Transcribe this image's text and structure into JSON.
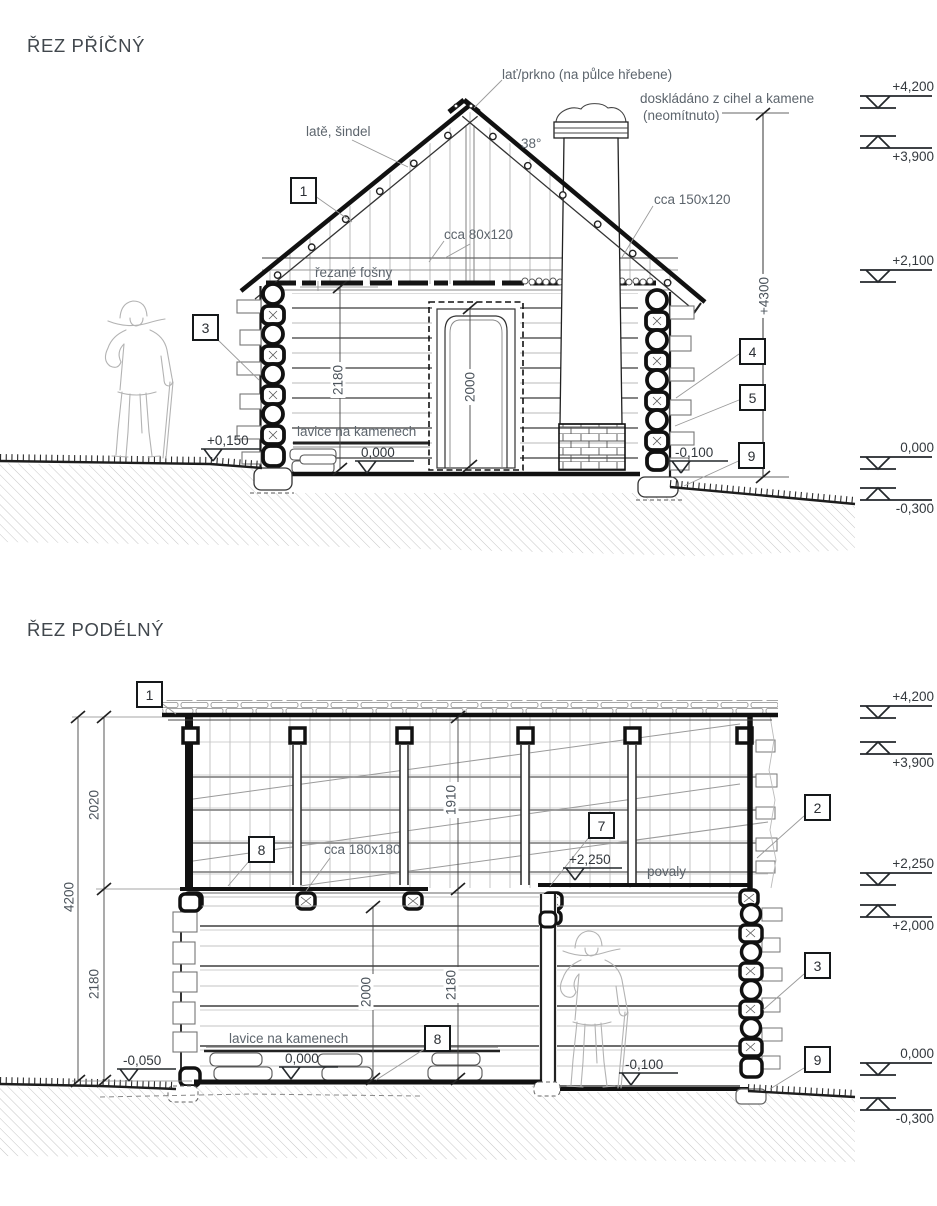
{
  "section1": {
    "title": "ŘEZ PŘÍČNÝ",
    "labels": {
      "ridge": "lať/prkno (na půlce hřebene)",
      "battens": "latě, šindel",
      "roof_angle": "38°",
      "chimney_note1": "doskládáno z cihel a kamene",
      "chimney_note2": "(neomítnuto)",
      "rafter_size": "cca 150x120",
      "tie_beam_size": "cca 80x120",
      "planks": "řezané fošny",
      "bench": "lavice na kamenech"
    },
    "dimensions": {
      "room_height": "2180",
      "door_height": "2000",
      "total_height": "+4300"
    },
    "spot_levels": {
      "terrain_left": "+0,150",
      "floor": "0,000",
      "terrain_right": "-0,100"
    },
    "callouts": {
      "c1": "1",
      "c3": "3",
      "c4": "4",
      "c5": "5",
      "c9": "9"
    },
    "level_marks": [
      {
        "label": "+4,200",
        "dir": "down"
      },
      {
        "label": "+3,900",
        "dir": "up"
      },
      {
        "label": "+2,100",
        "dir": "down"
      },
      {
        "label": "0,000",
        "dir": "down"
      },
      {
        "label": "-0,300",
        "dir": "up"
      }
    ]
  },
  "section2": {
    "title": "ŘEZ PODÉLNÝ",
    "labels": {
      "beam_size": "cca 180x180",
      "ceiling": "povaly",
      "bench": "lavice na kamenech"
    },
    "dimensions": {
      "total_height": "4200",
      "attic_height": "2020",
      "room_height": "2180",
      "attic_clear": "1910",
      "door_height": "2000",
      "room_clear": "2180"
    },
    "spot_levels": {
      "terrain_left": "-0,050",
      "ceiling_right": "+2,250",
      "floor": "0,000",
      "floor_right": "-0,100"
    },
    "callouts": {
      "c1": "1",
      "c2": "2",
      "c3": "3",
      "c7": "7",
      "c8a": "8",
      "c8b": "8",
      "c9": "9"
    },
    "level_marks": [
      {
        "label": "+4,200",
        "dir": "down"
      },
      {
        "label": "+3,900",
        "dir": "up"
      },
      {
        "label": "+2,250",
        "dir": "down"
      },
      {
        "label": "+2,000",
        "dir": "up"
      },
      {
        "label": "0,000",
        "dir": "down"
      },
      {
        "label": "-0,300",
        "dir": "up"
      }
    ]
  }
}
